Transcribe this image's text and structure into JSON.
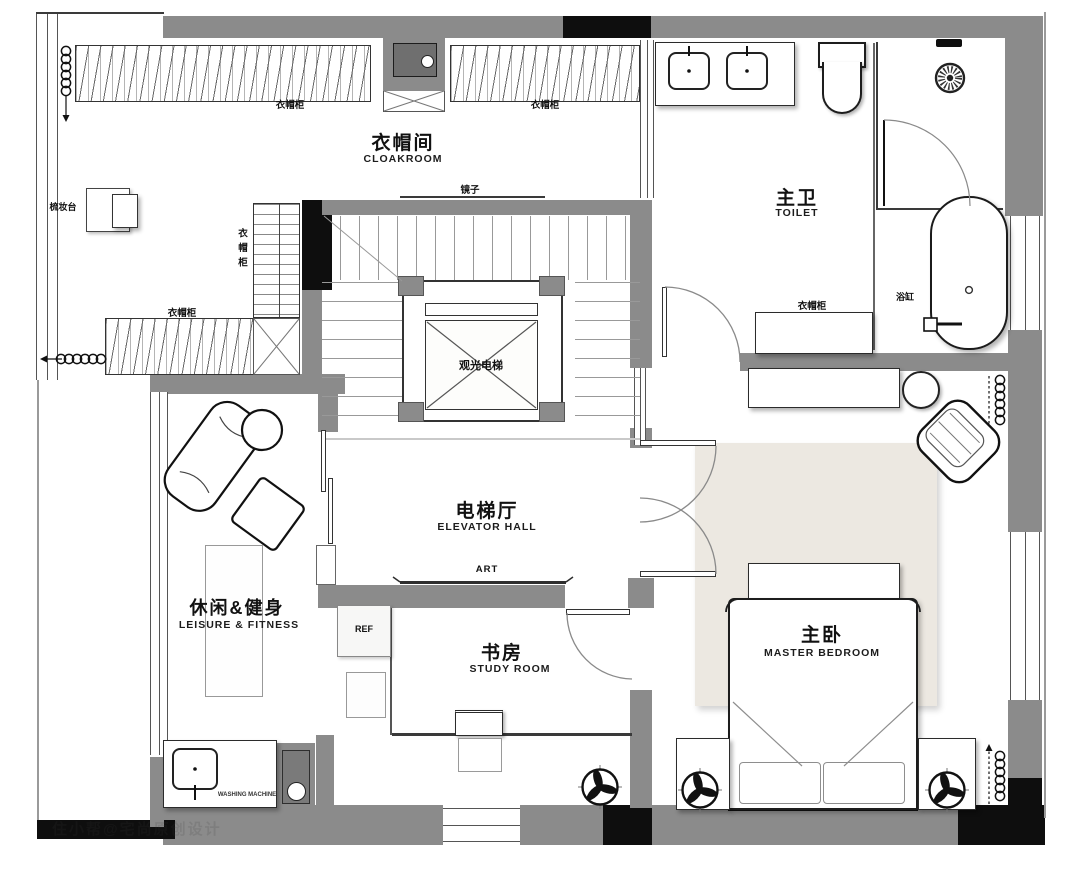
{
  "watermark": "住小帮@宅尚原创设计",
  "rooms": {
    "cloakroom": {
      "zh": "衣帽间",
      "en": "CLOAKROOM"
    },
    "toilet": {
      "zh": "主卫",
      "en": "TOILET"
    },
    "elevator_hall": {
      "zh": "电梯厅",
      "en": "ELEVATOR HALL"
    },
    "leisure": {
      "zh": "休闲&健身",
      "en": "LEISURE & FITNESS"
    },
    "study": {
      "zh": "书房",
      "en": "STUDY ROOM"
    },
    "bedroom": {
      "zh": "主卧",
      "en": "MASTER BEDROOM"
    }
  },
  "furniture": {
    "wardrobe_top_left": "衣帽柜",
    "wardrobe_top_right": "衣帽柜",
    "wardrobe_bottom": "衣帽柜",
    "wardrobe_side": "衣帽柜",
    "wardrobe_toilet": "衣帽柜",
    "dressing_table": "梳妆台",
    "mirror": "镜子",
    "elevator": "观光电梯",
    "bathtub": "浴缸",
    "art_wall": "ART",
    "fridge": "REF",
    "washing_machine": "WASHING MACHINE"
  },
  "colors": {
    "wall_gray": "#8b8b8b",
    "structure_black": "#0e0e0e",
    "rug_beige": "#ece8e1",
    "line_dark": "#3a3a3a"
  }
}
